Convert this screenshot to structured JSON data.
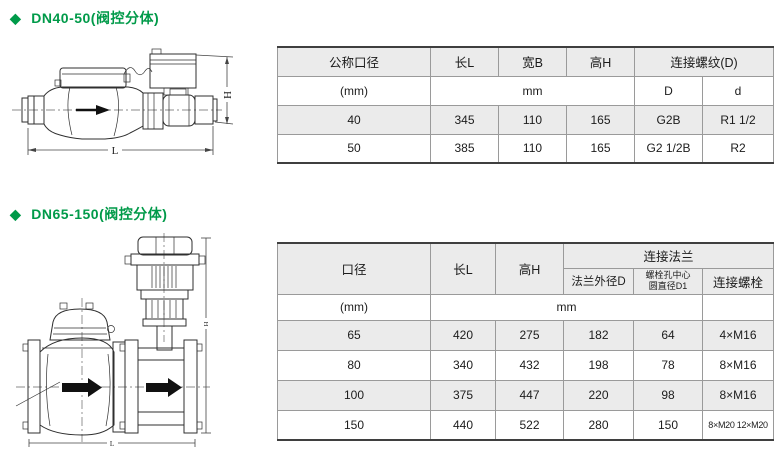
{
  "colors": {
    "heading_green": "#009a49",
    "row_shade": "#ebebeb",
    "table_border": "#9a9a9a",
    "text": "#1c1c1c"
  },
  "section_dn40_50": {
    "bullet": "◆",
    "heading": "DN40-50(阀控分体)",
    "diagram": {
      "height_dim_label": "H",
      "length_dim_label": "L"
    },
    "table": {
      "headers": {
        "nominal_diameter": "公称口径",
        "length": "长L",
        "width": "宽B",
        "height": "高H",
        "thread": "连接螺纹(D)",
        "thread_D": "D",
        "thread_d": "d"
      },
      "units": {
        "diameter_unit": "(mm)",
        "dims_unit": "mm"
      },
      "rows": [
        {
          "dn": "40",
          "length": "345",
          "width": "110",
          "height": "165",
          "thread_D": "G2B",
          "thread_d": "R1 1/2"
        },
        {
          "dn": "50",
          "length": "385",
          "width": "110",
          "height": "165",
          "thread_D": "G2 1/2B",
          "thread_d": "R2"
        }
      ]
    }
  },
  "section_dn65_150": {
    "bullet": "◆",
    "heading": "DN65-150(阀控分体)",
    "diagram": {
      "height_dim_label": "H",
      "length_dim_label": "L"
    },
    "table": {
      "headers": {
        "diameter": "口径",
        "length": "长L",
        "height": "高H",
        "flange": "连接法兰",
        "flange_od": "法兰外径D",
        "bolt_circle_line1": "螺栓孔中心",
        "bolt_circle_line2": "圆直径D1",
        "bolts": "连接螺栓"
      },
      "units": {
        "diameter_unit": "(mm)",
        "dims_unit": "mm"
      },
      "rows": [
        {
          "dn": "65",
          "length": "420",
          "height": "275",
          "flange_od": "182",
          "bolt_circle": "64",
          "bolts": "4×M16"
        },
        {
          "dn": "80",
          "length": "340",
          "height": "432",
          "flange_od": "198",
          "bolt_circle": "78",
          "bolts": "8×M16"
        },
        {
          "dn": "100",
          "length": "375",
          "height": "447",
          "flange_od": "220",
          "bolt_circle": "98",
          "bolts": "8×M16"
        },
        {
          "dn": "150",
          "length": "440",
          "height": "522",
          "flange_od": "280",
          "bolt_circle": "150",
          "bolts": "8×M20 12×M20"
        }
      ]
    }
  }
}
